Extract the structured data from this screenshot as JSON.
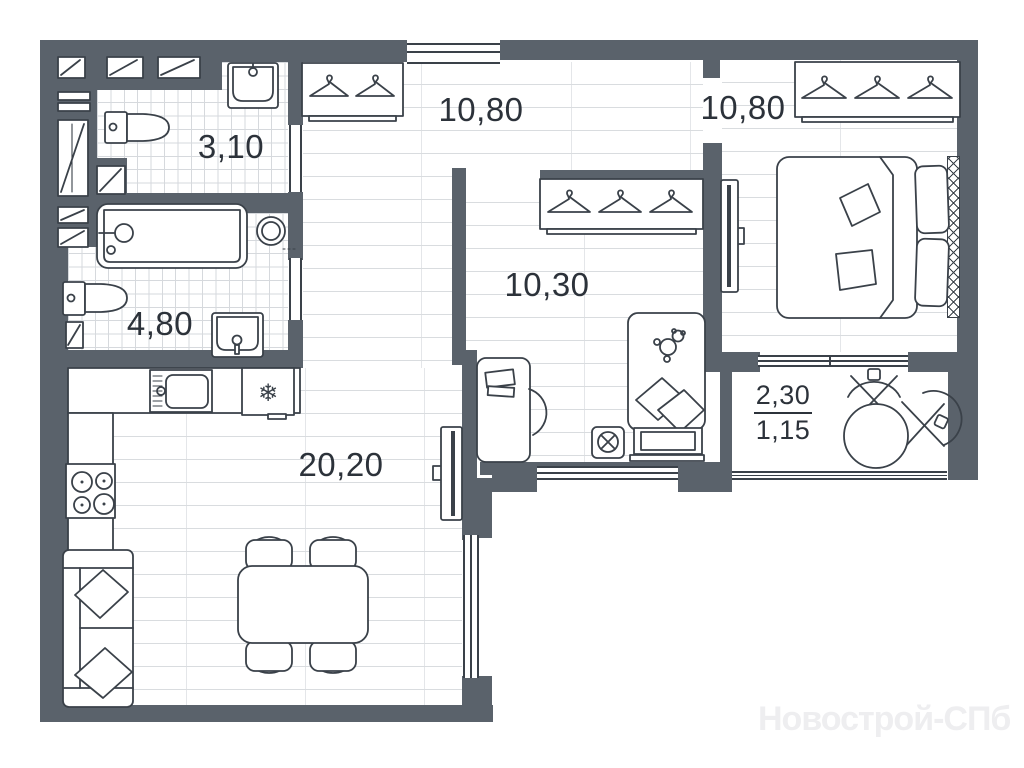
{
  "plan": {
    "watermark": "Новострой-СПб",
    "rooms": {
      "bath_small": {
        "area": "3,10"
      },
      "bath_large": {
        "area": "4,80"
      },
      "hallway": {
        "area": "10,80"
      },
      "kids_room": {
        "area": "10,30"
      },
      "bedroom": {
        "area": "10,80"
      },
      "living_kitchen": {
        "area": "20,20"
      },
      "balcony": {
        "area_full": "2,30",
        "area_counted": "1,15"
      }
    },
    "icons": {
      "fridge_snowflake": "❄"
    },
    "colors": {
      "wall": "#5a626b",
      "furniture_stroke": "#3a4149",
      "floor_line": "#d9dcdf",
      "label_text": "#2c323a",
      "watermark": "#eeeef0"
    }
  }
}
